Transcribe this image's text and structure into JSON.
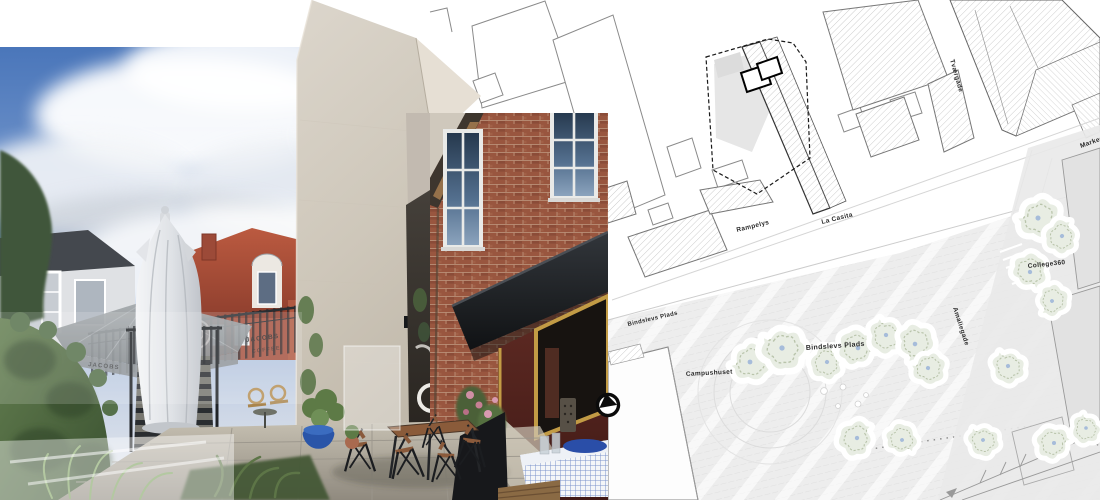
{
  "plan": {
    "labels": {
      "rampelys": "Rampelys",
      "la_casita": "La Casita",
      "bindslevs_plads_street": "Bindslevs Plads",
      "bindslevs_plads_square": "Bindslevs Plads",
      "campushuset": "Campushuset",
      "college360": "College360",
      "tvaergade": "Tværgade",
      "amaliegade": "Amaliegade",
      "markedsgade": "Markedsgade"
    },
    "icons": {
      "viewpoint_marker": "viewpoint-arrow-icon"
    },
    "colors": {
      "background": "#ffffff",
      "building_outline": "#8a8a8a",
      "hatch_line": "#c9c9c9",
      "site_boundary": "#1a1a1a",
      "new_footprint": "#000000",
      "plaza_fill": "#ededed",
      "tree_fill": "#e8ede3"
    }
  },
  "photo": {
    "signage": {
      "umbrella_brand": "JACOBS",
      "banner_word": "COFFEE"
    },
    "colors": {
      "sky": "#4a76ba",
      "concrete_tower": "#cfc8bc",
      "brick": "#99563f",
      "awning": "#1e2124",
      "kiosk_wall": "#5c2822",
      "plant_pot": "#2a55a8",
      "tablecloth": "#5a79c0"
    }
  }
}
